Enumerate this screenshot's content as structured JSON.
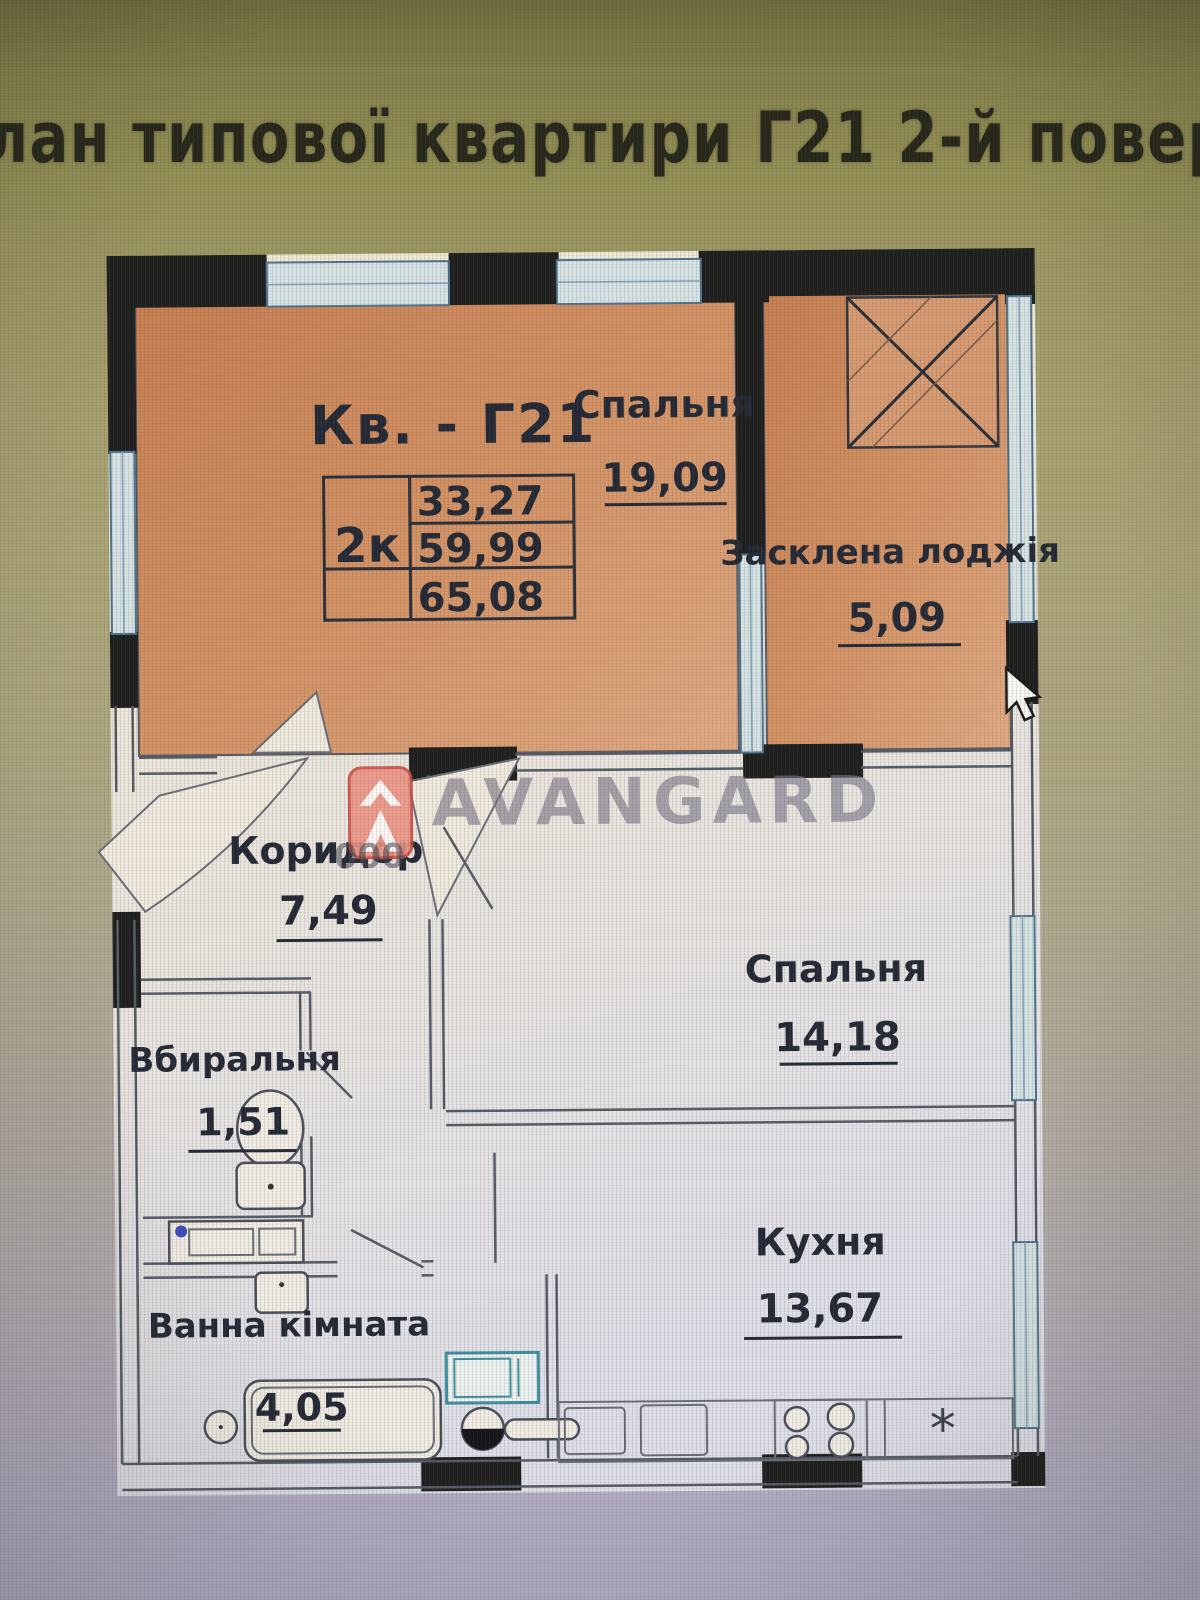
{
  "title": "лан типової квартири Г21 2-й поверх",
  "apartment": {
    "label": "Кв. - Г21",
    "type": "2к",
    "areas": [
      "33,27",
      "59,99",
      "65,08"
    ]
  },
  "rooms": [
    {
      "name": "Спальня",
      "area": "19,09"
    },
    {
      "name": "Засклена лоджія",
      "area": "5,09"
    },
    {
      "name": "Коридор",
      "area": "7,49"
    },
    {
      "name": "Спальня",
      "area": "14,18"
    },
    {
      "name": "Вбиральня",
      "area": "1,51"
    },
    {
      "name": "Ванна кімната",
      "area": "4,05"
    },
    {
      "name": "Кухня",
      "area": "13,67"
    }
  ],
  "watermark": {
    "brand": "AVANGARD",
    "stray_text": "000"
  },
  "icons": {
    "fridge_symbol": "*"
  },
  "colors": {
    "background_top": "#8a8650",
    "background_bottom": "#b1abc4",
    "paper": "#f0ead9",
    "room_fill": "#d79468",
    "wall": "#1f1f1f",
    "line": "#565b66",
    "glass": "#d7e3e5",
    "label": "#242936",
    "logo_red": "#cc4f44",
    "watermark_gray": "#7d7889"
  }
}
